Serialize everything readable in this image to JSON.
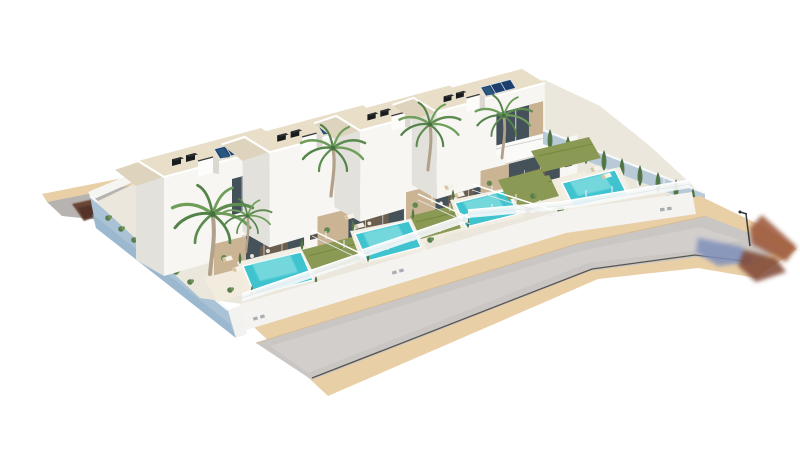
{
  "scene": {
    "type": "3d-architectural-render",
    "description": "Aerial 3D rendering of a residential development with four modern two-storey white villas, each with rooftop solar panels, roof vents, palm trees, private lawn, sun loungers and a private swimming pool, enclosed by white fences and a light-blue perimeter wall, fronted by an asphalt street with sand-coloured sidewalks, a street lamp and plant shadows on the pavement."
  },
  "development": {
    "villa_count": 4,
    "villas": [
      {
        "id": 1,
        "storeys": 2,
        "solar_panels": 3,
        "roof_vents": 2,
        "chimney": true,
        "pool": true,
        "lawn": true,
        "loungers": 2,
        "palm_trees": 1,
        "dining_set": true
      },
      {
        "id": 2,
        "storeys": 2,
        "solar_panels": 3,
        "roof_vents": 2,
        "chimney": true,
        "pool": true,
        "lawn": true,
        "loungers": 2,
        "palm_trees": 1,
        "dining_set": true
      },
      {
        "id": 3,
        "storeys": 2,
        "solar_panels": 3,
        "roof_vents": 2,
        "chimney": true,
        "pool": true,
        "lawn": true,
        "loungers": 2,
        "palm_trees": 1,
        "dining_set": true
      },
      {
        "id": 4,
        "storeys": 2,
        "solar_panels": 3,
        "roof_vents": 2,
        "chimney": true,
        "pool": true,
        "lawn": true,
        "loungers": 2,
        "palm_trees": 1,
        "garden": "large",
        "cypress_hedge": true
      }
    ],
    "environment": {
      "front_street": true,
      "rear_street": true,
      "sidewalks": 2,
      "street_lamp": 1,
      "cypress_trees": 9,
      "fences": "white-rail",
      "perimeter_wall": "light-blue"
    }
  },
  "palette": {
    "background": "#ffffff",
    "plot_ground": "#ece7dd",
    "terrace": "#f2ecdf",
    "building_front": "#f7f6f3",
    "building_side": "#e3e1dc",
    "roof": "#e9dfc9",
    "fascia": "#ffffff",
    "solar_panel": "#1d3f6e",
    "solar_cell": "#2b567f",
    "solar_frame": "#dde3e8",
    "vent": "#1a1b1d",
    "vent_side": "#2e3033",
    "chimney": "#fcfcfb",
    "chimney_side": "#dbd8d2",
    "glass": "#44505a",
    "glass_ground": "#46525a",
    "wood_accent": "#c8b292",
    "wood_wall": "#cbb494",
    "interior_glow": "#76624c",
    "parapet": "#fafaf8",
    "pool_water": "#3fc3cf",
    "pool_sparkle": "#8fe3e4",
    "pool_deck": "#f3eee4",
    "pool_coping": "#ffffff",
    "lawn": "#8a9a55",
    "lawn_shade": "#76873f",
    "shrub": "#5a7c48",
    "cypress": "#567b4a",
    "cypress_trunk": "#44603a",
    "palm_trunk": "#b2a18a",
    "palm_frond": "#5e8c50",
    "palm_frond_light": "#6f9e5b",
    "palm_frond_dark": "#54834a",
    "palm_core": "#46703f",
    "left_wall": "#a9c2d6",
    "left_wall_shade": "#93b1c9",
    "wall_cap": "#f6f8fa",
    "wall_end": "#f2f2f0",
    "rear_wall": "#f5f5f2",
    "front_wall": "#f4f3f0",
    "wall_vent": "#a7adb3",
    "fence_band": "#f7f9fa",
    "fence_rail": "#ffffff",
    "fence_rail2": "#e3e7ea",
    "fence_post": "#eef0f2",
    "sidewalk": "#e9cfa6",
    "sidewalk_line": "#d6ba90",
    "road": "#c9c6c3",
    "road_light": "#d4d1ce",
    "road_edge": "#5a544e",
    "rear_road": "#b7b3b0",
    "rear_shadow": "#6b4434",
    "rear_shadow_dark": "#52302a",
    "shadow_blue": "#8090bb",
    "shadow_rust": "#9e5a3e",
    "shadow_rust_dark": "#7e4430",
    "lounger_body": "#f5f2ea",
    "lounger_cushion": "#d9c4a0",
    "table_wood": "#8a6e50",
    "chair_light": "#ece6da",
    "lamp": "#3c3c3c"
  }
}
